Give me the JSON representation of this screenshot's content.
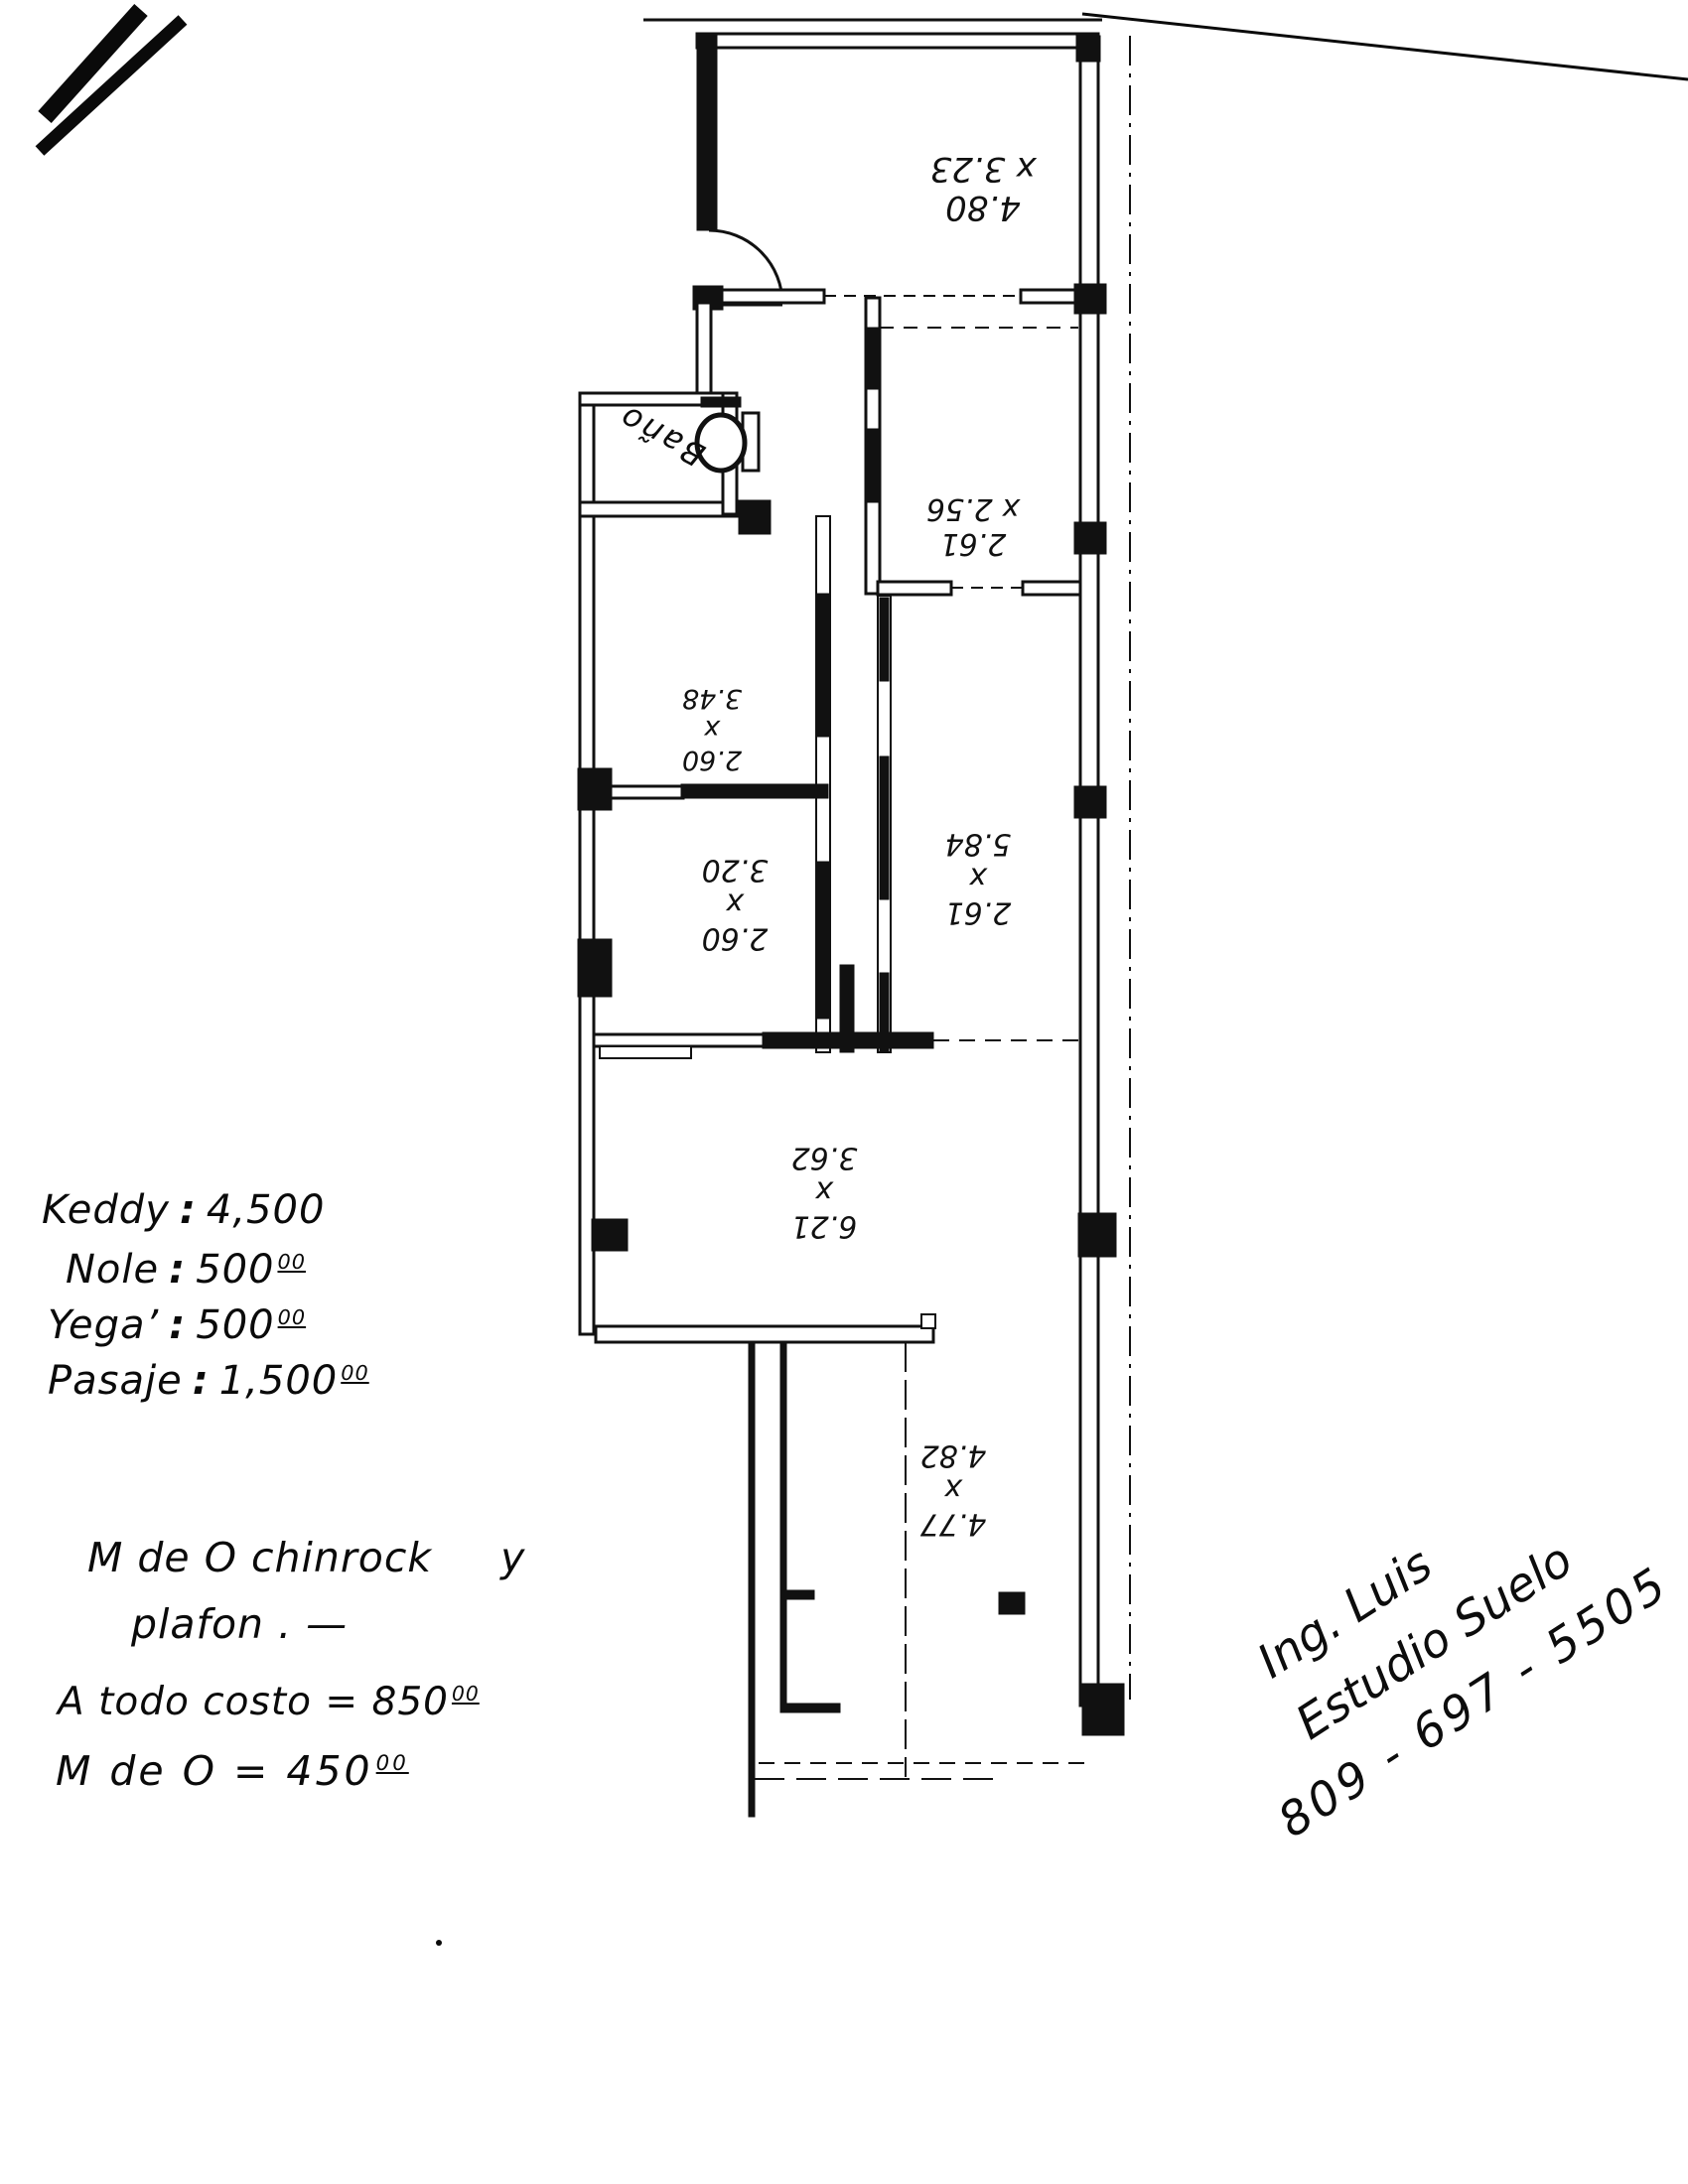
{
  "floor_plan": {
    "bathroom_label": "Baño",
    "rooms": [
      {
        "name": "room-top",
        "lines": [
          "4.80",
          "x 3.23"
        ]
      },
      {
        "name": "room-upper-right",
        "lines": [
          "2.61",
          "x 2.56"
        ]
      },
      {
        "name": "room-mid-left-1",
        "lines": [
          "2.60",
          "x",
          "3.48"
        ]
      },
      {
        "name": "room-mid-left-2",
        "lines": [
          "2.60",
          "x",
          "3.20"
        ]
      },
      {
        "name": "room-mid-right",
        "lines": [
          "2.61",
          "x",
          "5.84"
        ]
      },
      {
        "name": "room-lower-wide",
        "lines": [
          "6.21",
          "x",
          "3.62"
        ]
      },
      {
        "name": "room-bottom",
        "lines": [
          "4.77",
          "x",
          "4.82"
        ]
      }
    ]
  },
  "payment_notes": {
    "lines": [
      {
        "label": "Keddy",
        "colon": ":",
        "amount": "4,500",
        "sup": ""
      },
      {
        "label": "Nole",
        "colon": ":",
        "amount": "500",
        "sup": "00"
      },
      {
        "label": "Yega’",
        "colon": ":",
        "amount": "500",
        "sup": "00"
      },
      {
        "label": "Pasaje",
        "colon": ":",
        "amount": "1,500",
        "sup": "00"
      }
    ]
  },
  "work_notes": {
    "line1": "M de O chinrock",
    "line1_suffix": "y",
    "line2": "plafon . —",
    "line3_label": "A todo costo = ",
    "line3_amount": "850",
    "line3_sup": "00",
    "line4_label": "M de O = ",
    "line4_amount": "450",
    "line4_sup": "00"
  },
  "signature": {
    "line1": "Ing. Luis",
    "line2": "Estudio Suelo",
    "line3": "809 - 697 - 5505"
  }
}
